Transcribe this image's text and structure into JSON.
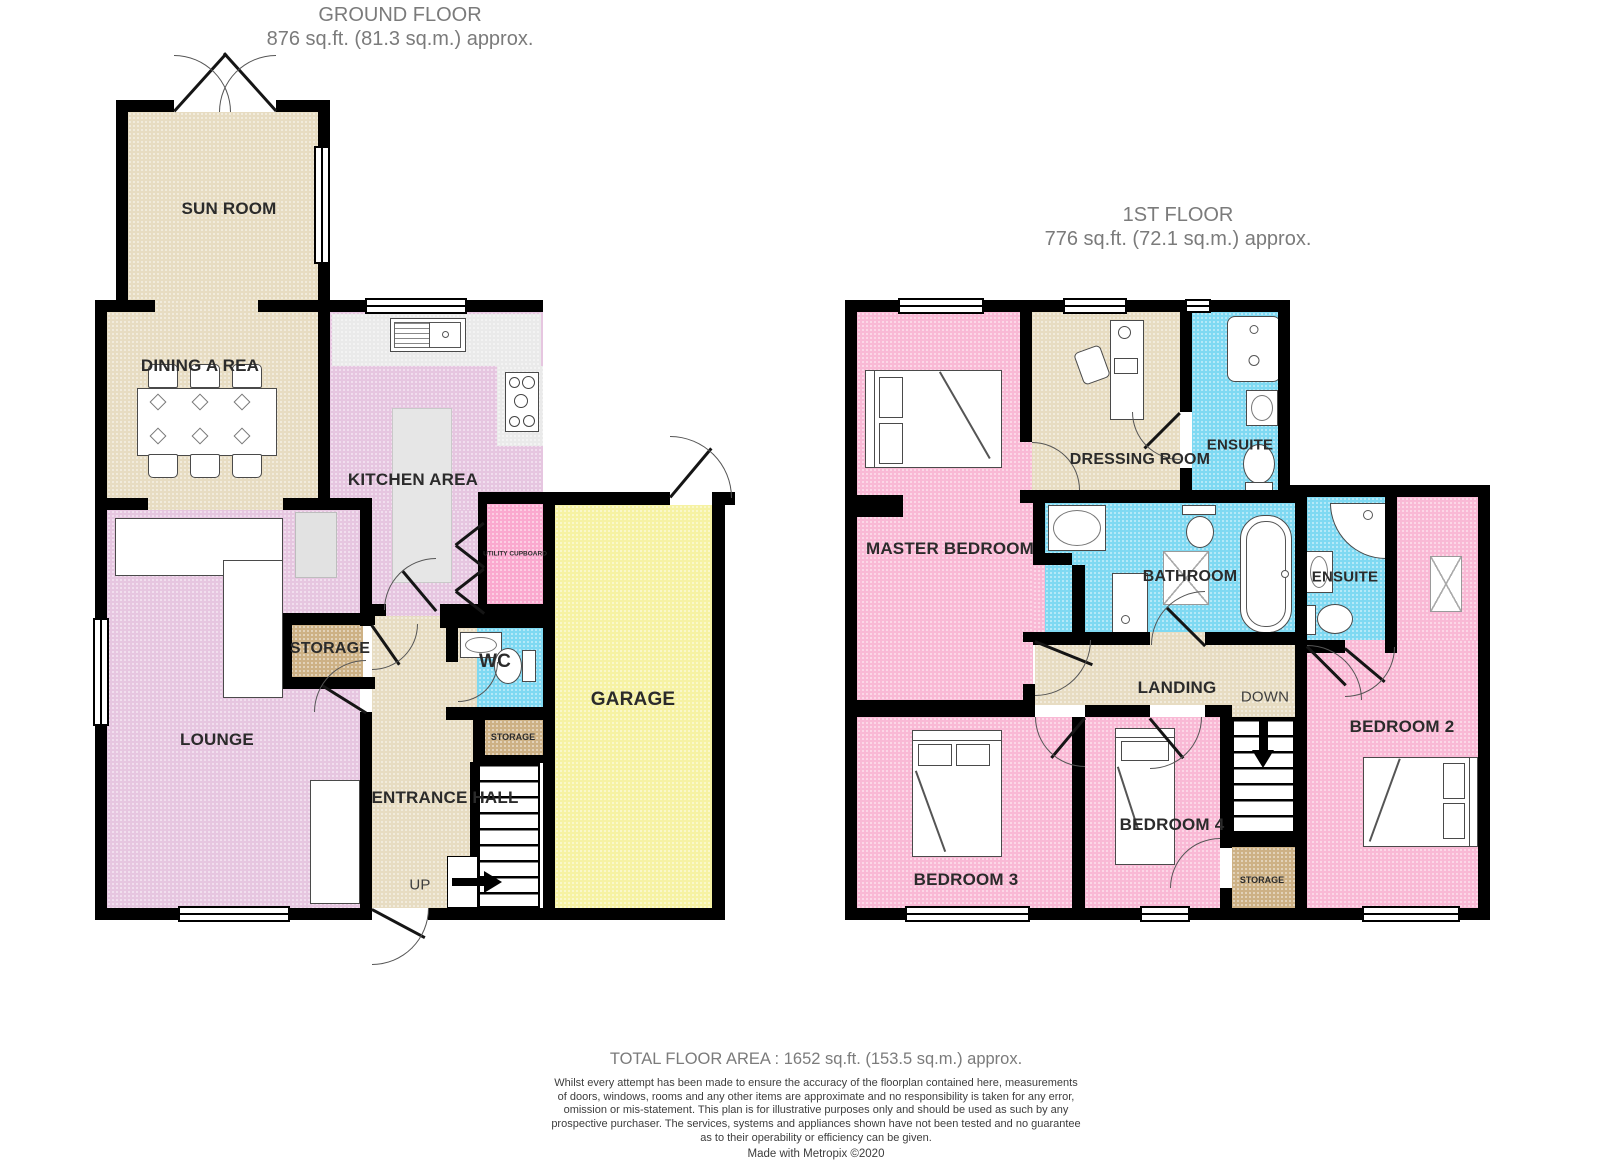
{
  "colors": {
    "beige": "#E7DCC2",
    "lilac": "#E6C6E0",
    "bedroom_pink": "#F9B9D5",
    "utility_pink": "#FAA9CF",
    "bathroom_blue": "#7FD9F2",
    "garage_yellow": "#F6F2A3",
    "storage_brown": "#CDB185",
    "counter_grey": "#EAEAEA",
    "wall_black": "#000000",
    "title_grey": "#7B7B7B",
    "label_dark": "#2B2B2B"
  },
  "ground_floor": {
    "title": "GROUND FLOOR",
    "subtitle": "876 sq.ft. (81.3 sq.m.) approx.",
    "rooms": {
      "sun_room": "SUN ROOM",
      "dining_area": "DINING A REA",
      "kitchen_area": "KITCHEN AREA",
      "lounge": "LOUNGE",
      "storage": "STORAGE",
      "utility_cupboard": "UTILITY CUPBOARD",
      "wc": "WC",
      "storage_small": "STORAGE",
      "entrance_hall": "ENTRANCE HALL",
      "up": "UP",
      "garage": "GARAGE"
    }
  },
  "first_floor": {
    "title": "1ST FLOOR",
    "subtitle": "776 sq.ft. (72.1 sq.m.) approx.",
    "rooms": {
      "master_bedroom": "MASTER BEDROOM",
      "dressing_room": "DRESSING ROOM",
      "ensuite_1": "ENSUITE",
      "bathroom": "BATHROOM",
      "ensuite_2": "ENSUITE",
      "landing": "LANDING",
      "down": "DOWN",
      "bedroom_2": "BEDROOM 2",
      "bedroom_3": "BEDROOM 3",
      "bedroom_4": "BEDROOM 4",
      "storage": "STORAGE"
    }
  },
  "footer": {
    "total_area": "TOTAL FLOOR AREA : 1652 sq.ft. (153.5 sq.m.) approx.",
    "disclaimer": "Whilst every attempt has been made to ensure the accuracy of the floorplan contained here, measurements\nof doors, windows, rooms and any other items are approximate and no responsibility is taken for any error,\nomission or mis-statement. This plan is for illustrative purposes only and should be used as such by any\nprospective purchaser. The services, systems and appliances shown have not been tested and no guarantee\nas to their operability or efficiency can be given.",
    "credit": "Made with Metropix ©2020"
  }
}
